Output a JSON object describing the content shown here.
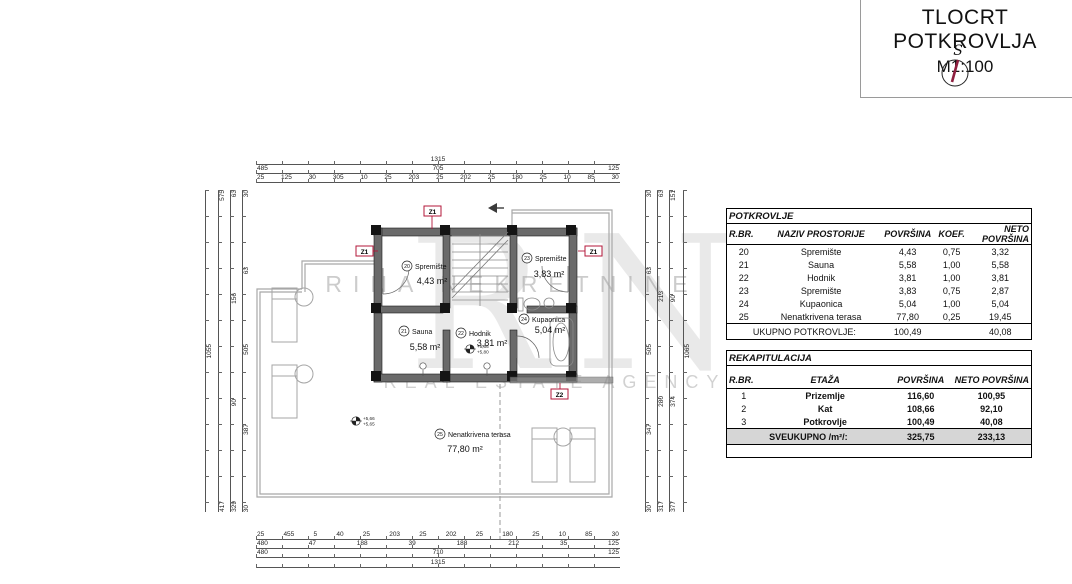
{
  "title_block": {
    "title": "TLOCRT POTKROVLJA",
    "scale": "M1:100",
    "compass_label": "S"
  },
  "colors": {
    "accent_red": "#b3173a",
    "wall_fill": "#6a6a6a",
    "outline_gray": "#a8a8a8",
    "footer_gray": "#d6d6d6"
  },
  "watermark": {
    "monogram": "RN",
    "line1": "RINA NEKRETNINE",
    "line2": "REAL ESTATE AGENCY"
  },
  "plan": {
    "rooms": [
      {
        "num": "20",
        "name": "Spremište",
        "area": "4,43 m²"
      },
      {
        "num": "21",
        "name": "Sauna",
        "area": "5,58 m²"
      },
      {
        "num": "22",
        "name": "Hodnik",
        "area": "3,81 m²"
      },
      {
        "num": "23",
        "name": "Spremište",
        "area": "3,83 m²"
      },
      {
        "num": "24",
        "name": "Kupaonica",
        "area": "5,04 m²"
      },
      {
        "num": "25",
        "name": "Nenatkrivena terasa",
        "area": "77,80 m²"
      }
    ],
    "markers": {
      "z1": "Z1",
      "z2": "Z2"
    },
    "elevations": {
      "terrace_top": "+5,66",
      "terrace_bottom": "+5,65",
      "hodnik_top": "+5,66",
      "hodnik_bottom": "+5,80"
    }
  },
  "dims": {
    "top": {
      "total": "1315",
      "row2": [
        "485",
        "705",
        "125"
      ],
      "row3": [
        "25",
        "125",
        "30",
        "305",
        "10",
        "25",
        "203",
        "25",
        "202",
        "25",
        "180",
        "25",
        "10",
        "85",
        "30"
      ]
    },
    "bottom": {
      "row1": [
        "25",
        "455",
        "5",
        "40",
        "25",
        "203",
        "25",
        "202",
        "25",
        "180",
        "25",
        "10",
        "85",
        "30"
      ],
      "row2": [
        "480",
        "47",
        "188",
        "39",
        "188",
        "212",
        "35",
        "125"
      ],
      "row3": [
        "480",
        "710",
        "125"
      ],
      "total": "1315"
    },
    "left": {
      "chain1": [
        "30",
        "63",
        "505",
        "387",
        "30"
      ],
      "chain2": [
        "63",
        "156",
        "90",
        "329"
      ],
      "chain3": [
        "575",
        "417"
      ],
      "total": "1055"
    },
    "right": {
      "chain1": [
        "30",
        "63",
        "505",
        "347",
        "30"
      ],
      "chain2": [
        "63",
        "213",
        "280",
        "317"
      ],
      "chain3": [
        "151",
        "90",
        "374",
        "377"
      ],
      "total": "1065"
    }
  },
  "tables": {
    "potkrovlje": {
      "title": "POTKROVLJE",
      "headers": [
        "R.BR.",
        "NAZIV PROSTORIJE",
        "POVRŠINA",
        "KOEF.",
        "NETO POVRŠINA"
      ],
      "rows": [
        [
          "20",
          "Spremište",
          "4,43",
          "0,75",
          "3,32"
        ],
        [
          "21",
          "Sauna",
          "5,58",
          "1,00",
          "5,58"
        ],
        [
          "22",
          "Hodnik",
          "3,81",
          "1,00",
          "3,81"
        ],
        [
          "23",
          "Spremište",
          "3,83",
          "0,75",
          "2,87"
        ],
        [
          "24",
          "Kupaonica",
          "5,04",
          "1,00",
          "5,04"
        ],
        [
          "25",
          "Nenatkrivena terasa",
          "77,80",
          "0,25",
          "19,45"
        ]
      ],
      "footer": {
        "label": "UKUPNO POTKROVLJE:",
        "povrsina": "100,49",
        "neto": "40,08"
      }
    },
    "rekapitulacija": {
      "title": "REKAPITULACIJA",
      "headers": [
        "R.BR.",
        "ETAŽA",
        "POVRŠINA",
        "NETO POVRŠINA"
      ],
      "rows": [
        [
          "1",
          "Prizemlje",
          "116,60",
          "100,95"
        ],
        [
          "2",
          "Kat",
          "108,66",
          "92,10"
        ],
        [
          "3",
          "Potkrovlje",
          "100,49",
          "40,08"
        ]
      ],
      "footer": {
        "label": "SVEUKUPNO /m²/:",
        "povrsina": "325,75",
        "neto": "233,13"
      }
    }
  }
}
